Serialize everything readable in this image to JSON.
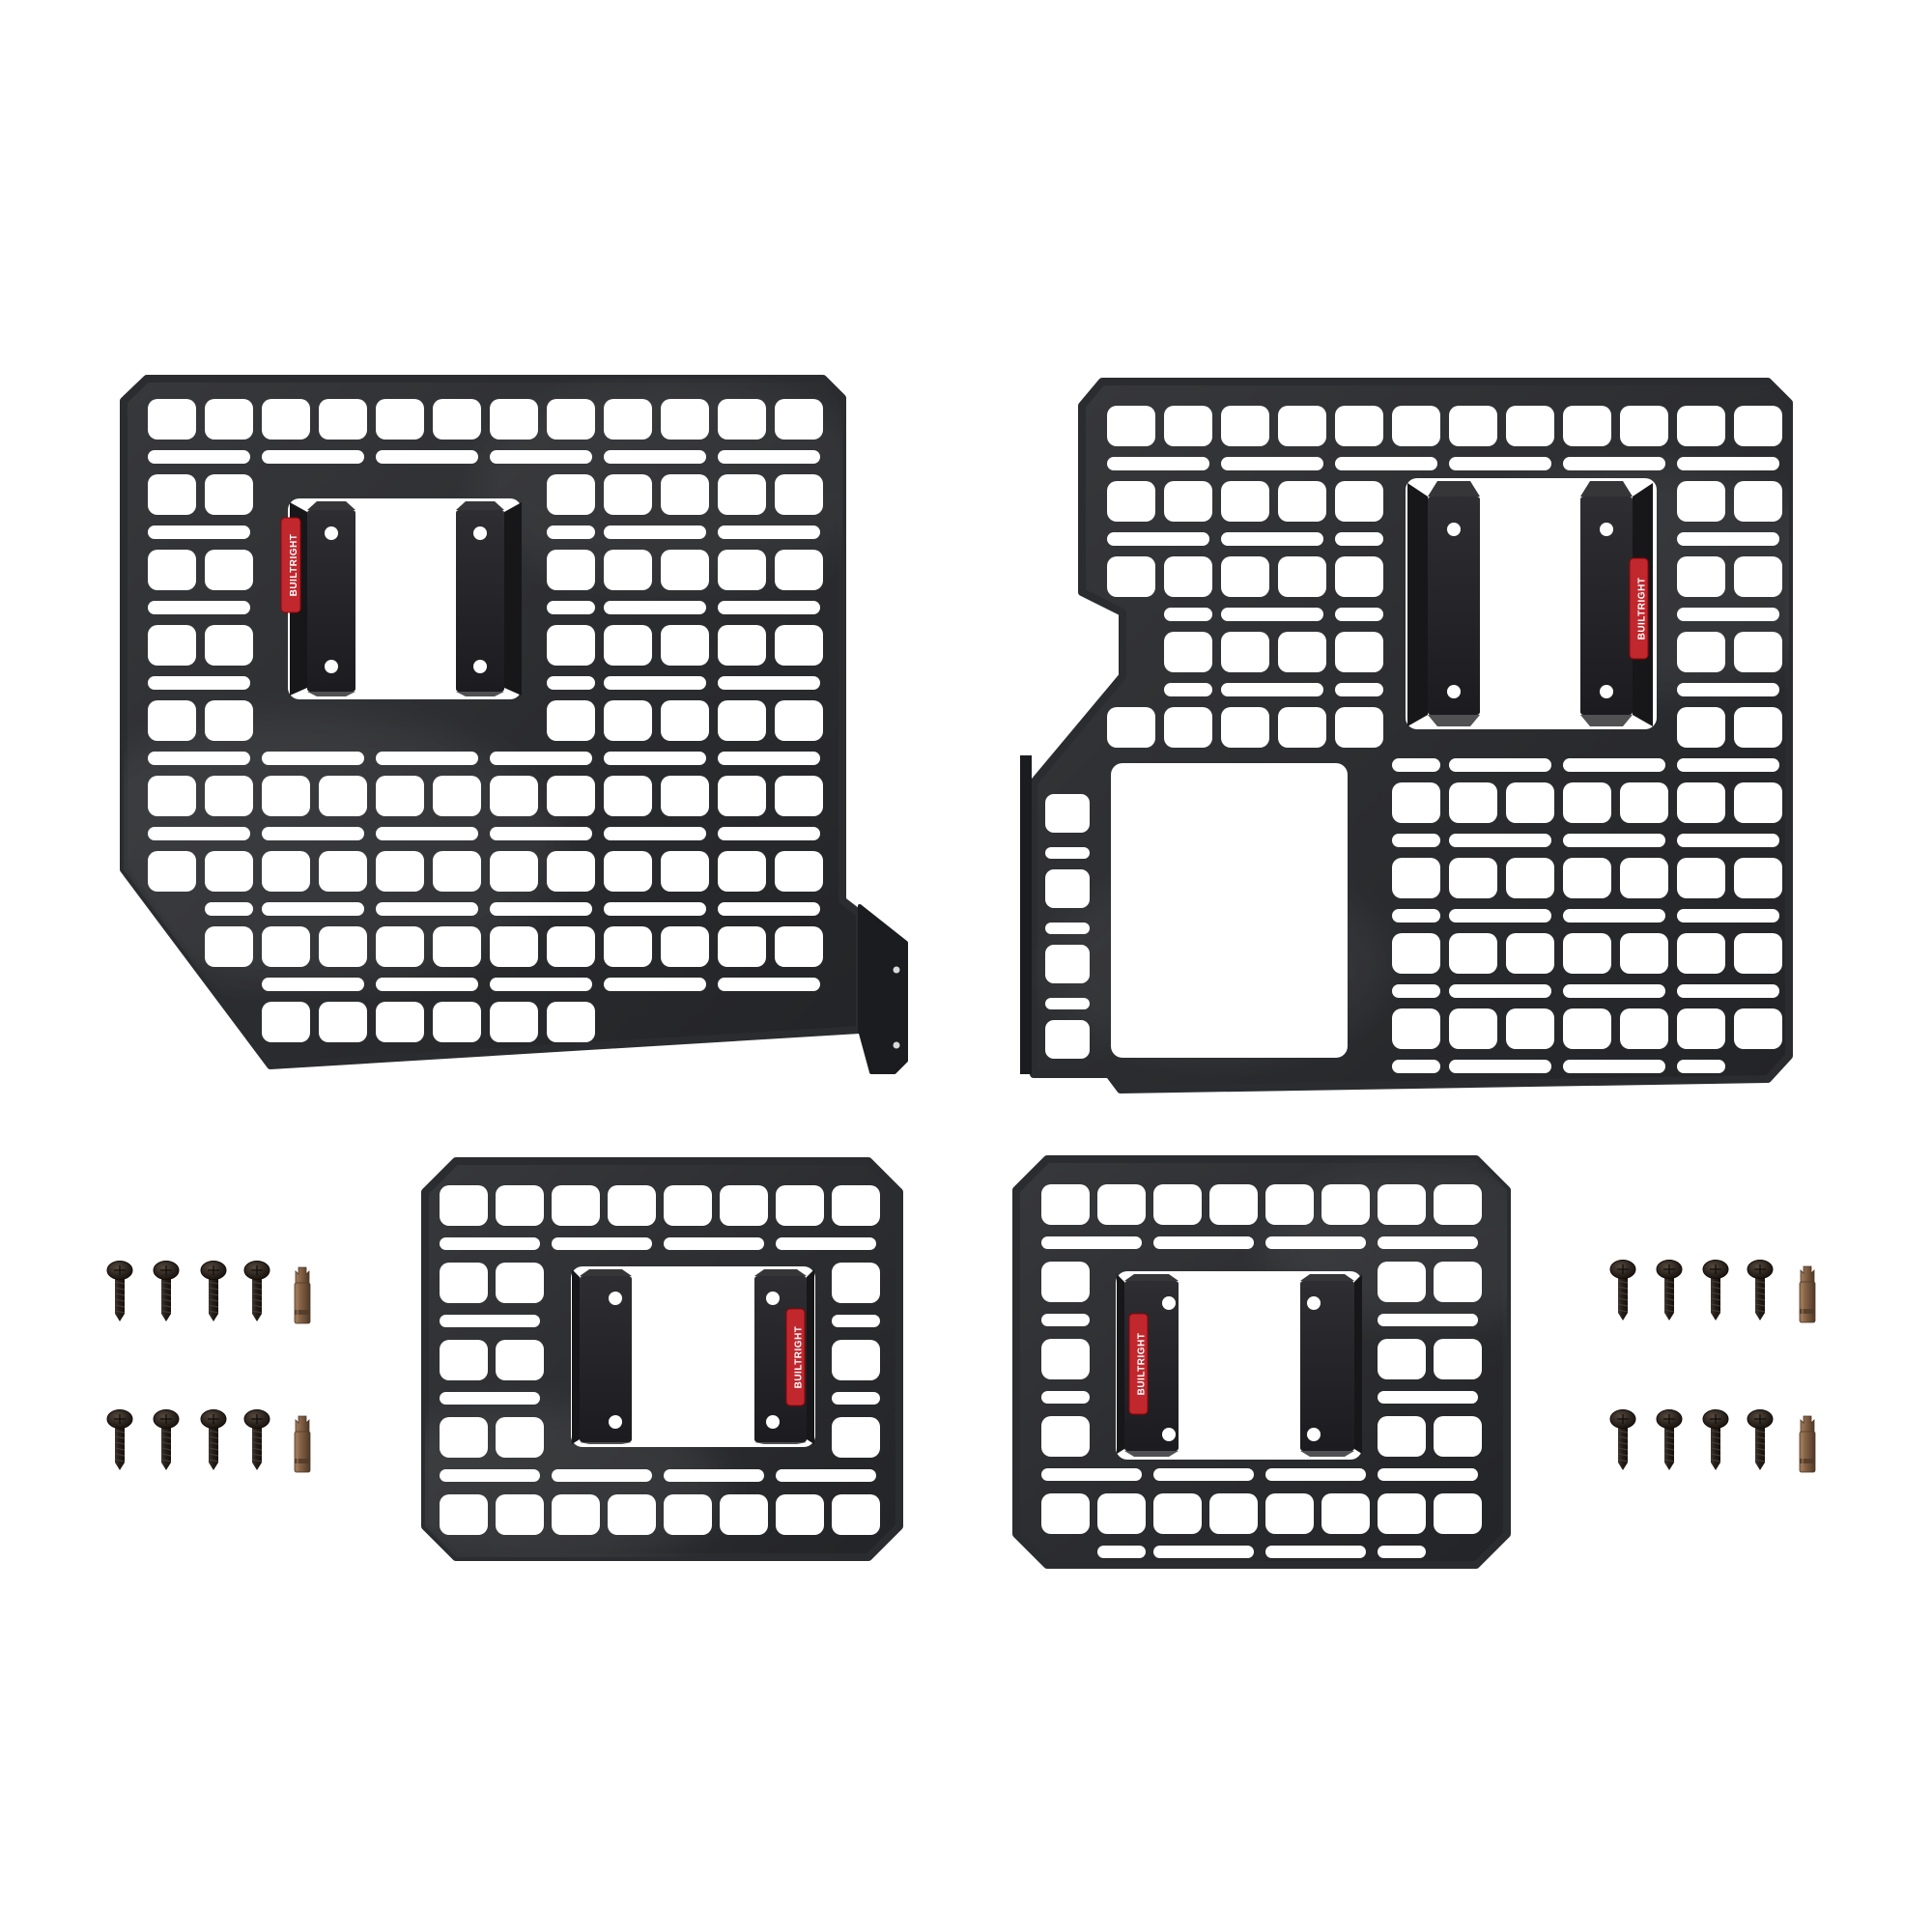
{
  "scene": {
    "background_color": "#ffffff",
    "item_counts": {
      "molle_panels": 4,
      "mounting_screws": 16,
      "driver_bits": 4,
      "brand_labels": 4
    }
  },
  "brand": {
    "label_text": "BUILTRIGHT",
    "label_color": "#c0282e",
    "label_text_color": "#ffffff"
  },
  "colors": {
    "panel": "#2b2c2f",
    "bracket_face": "#242428",
    "bracket_shadow": "#17171a",
    "hole": "#ffffff",
    "screw_body": "#241d17",
    "screw_highlight": "#56493e",
    "bit_bronze": "#7b5a40",
    "bit_bronze_light": "#a17c5a",
    "bit_bronze_dark": "#4f3928"
  },
  "panels": [
    {
      "id": "top-left",
      "type": "large-molle-panel",
      "label_on": "left-bracket"
    },
    {
      "id": "top-right",
      "type": "large-molle-panel",
      "label_on": "right-bracket"
    },
    {
      "id": "bottom-left",
      "type": "small-molle-panel",
      "label_on": "right-bracket"
    },
    {
      "id": "bottom-right",
      "type": "small-molle-panel",
      "label_on": "left-bracket"
    }
  ],
  "hardware": {
    "clusters": 2,
    "rows_per_cluster": 2,
    "screws_per_row": 4,
    "bits_per_row": 1
  }
}
